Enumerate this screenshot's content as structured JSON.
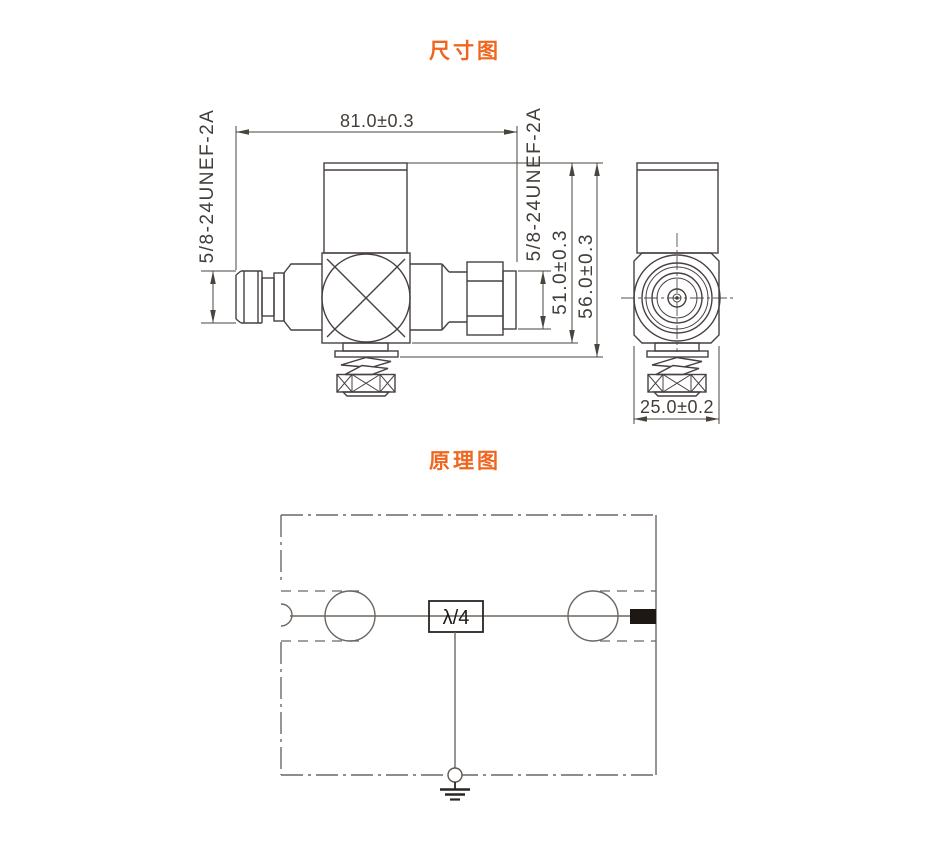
{
  "titles": {
    "dimension_title": "尺寸图",
    "schematic_title": "原理图",
    "accent_color": "#f0661e"
  },
  "dimension_drawing": {
    "overall_length": "81.0±0.3",
    "left_thread_spec": "5/8-24UNEF-2A",
    "right_thread_spec": "5/8-24UNEF-2A",
    "body_height": "51.0±0.3",
    "overall_height": "56.0±0.3",
    "body_width": "25.0±0.2",
    "line_color": "#474140"
  },
  "schematic": {
    "quarter_wave_label": "λ/4",
    "line_color": "#6e6660",
    "icons": [
      "input-port-arc",
      "coax-connector-circle-left",
      "quarter-wave-stub-box",
      "coax-connector-circle-right",
      "output-port-block",
      "earth-ground-symbol"
    ]
  }
}
